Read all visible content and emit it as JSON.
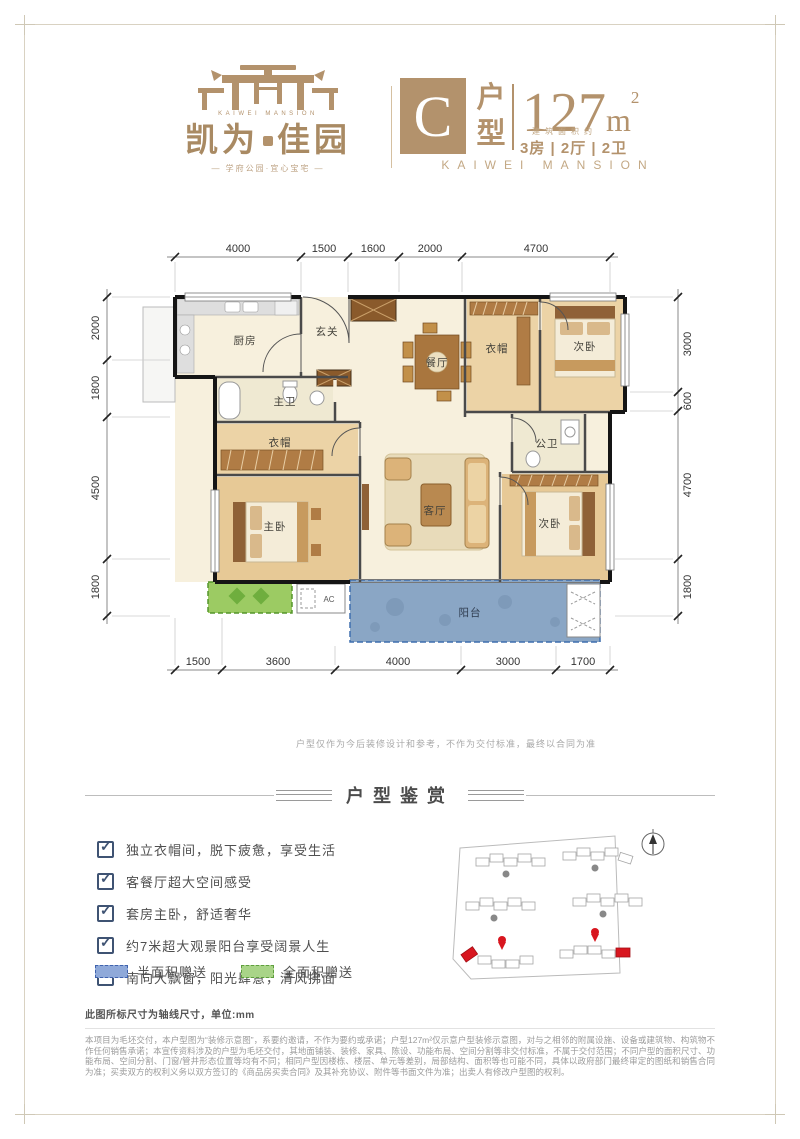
{
  "brand": {
    "name_cn_left": "凯为",
    "name_cn_right": "佳园",
    "name_en": "KAIWEI MANSION",
    "tagline": "— 学府公园·宜心宝宅 —",
    "accent_color": "#b3926c"
  },
  "unit": {
    "letter": "C",
    "type_char_top": "户",
    "type_char_bottom": "型",
    "area_value": "127",
    "area_unit": "m",
    "area_sup": "2",
    "area_caption": "建筑面积约",
    "rooms_summary": "3房 | 2厅 | 2卫",
    "brand_en": "KAIWEI MANSION"
  },
  "floorplan": {
    "dims_top": [
      "4000",
      "1500",
      "1600",
      "2000",
      "4700"
    ],
    "dims_bottom": [
      "1500",
      "3600",
      "4000",
      "3000",
      "1700"
    ],
    "dims_left": [
      "2000",
      "1800",
      "4500",
      "1800"
    ],
    "dims_right": [
      "3000",
      "600",
      "4700",
      "1800"
    ],
    "rooms": {
      "kitchen": "厨房",
      "foyer": "玄关",
      "dining": "餐厅",
      "closet_top": "衣帽",
      "bedroom_top": "次卧",
      "bath_master": "主卫",
      "bath_public": "公卫",
      "closet_master": "衣帽",
      "bedroom_master": "主卧",
      "living": "客厅",
      "bedroom_bottom": "次卧",
      "balcony": "阳台",
      "ac_label": "AC"
    },
    "note": "户型仅作为今后装修设计和参考，不作为交付标准，最终以合同为准"
  },
  "appreciation": {
    "title": "户型鉴赏",
    "features": [
      "独立衣帽间，脱下疲惫，享受生活",
      "客餐厅超大空间感受",
      "套房主卧，舒适奢华",
      "约7米超大观景阳台享受阔景人生",
      "南向大飘窗，阳光肆意，清风拂面"
    ],
    "legend": [
      {
        "label": "半面积赠送",
        "fill": "#8fa9d9",
        "border": "#3f62ad"
      },
      {
        "label": "全面积赠送",
        "fill": "#a9d488",
        "border": "#5f9e3e"
      }
    ]
  },
  "footer": {
    "dim_note": "此图所标尺寸为轴线尺寸，单位:mm",
    "disclaimer": "本项目为毛坯交付，本户型图为“装修示意图”，系要约邀请，不作为要约或承诺；户型127m²仅示意户型装修示意图，对与之相邻的附属设施、设备或建筑物、构筑物不作任何销售承诺；本宣传资料涉及的户型为毛坯交付，其地面铺装、装修、家具、陈设、功能布局、空间分割等非交付标准，不属于交付范围；不同户型的面积尺寸、功能布局、空间分割、门窗/管井形态位置等均有不同；相同户型因楼栋、楼层、单元等差别，局部结构、面积等也可能不同，具体以政府部门最终审定的图纸和销售合同为准；买卖双方的权利义务以双方签订的《商品房买卖合同》及其补充协议、附件等书面文件为准；出卖人有修改户型图的权利。"
  }
}
